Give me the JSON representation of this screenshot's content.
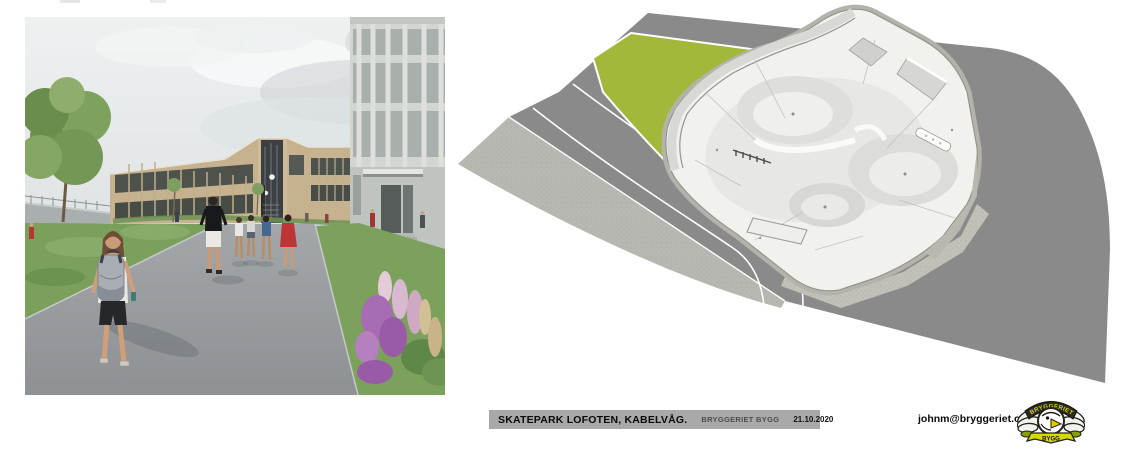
{
  "page": {
    "background": "#ffffff"
  },
  "left_panel": {
    "label": "school-courtyard-rendering",
    "description": "Rendered perspective of a schoolyard: students walk on a grey path toward a tan two-storey school building next to an existing light-grey building, with lawns, a tree and purple flower beds"
  },
  "right_panel": {
    "label": "skatepark-3d-rendering",
    "description": "Aerial 3D model of a white concrete skatepark with bowls, rails and ledges on a grey paved lot, bordered by an olive-green lawn and a curving road with white lane lines"
  },
  "footer": {
    "title": "SKATEPARK LOFOTEN, KABELVÅG.",
    "company": "BRYGGERIET BYGG",
    "date": "21.10.2020",
    "email": "johnm@bryggeriet.org"
  },
  "logo": {
    "name": "bryggeriet-bygg-badge",
    "text_top": "BRYGGERIET",
    "text_bottom": "BYGG"
  },
  "colors": {
    "lawn_green": "#a2b83b",
    "road_gray": "#8a8a8a",
    "light_pavement": "#b7b8b2",
    "concrete_white": "#f1f1ee",
    "titlebar_gray": "#a9a9a9",
    "logo_yellow": "#d6d800",
    "logo_black": "#1d1d16"
  }
}
